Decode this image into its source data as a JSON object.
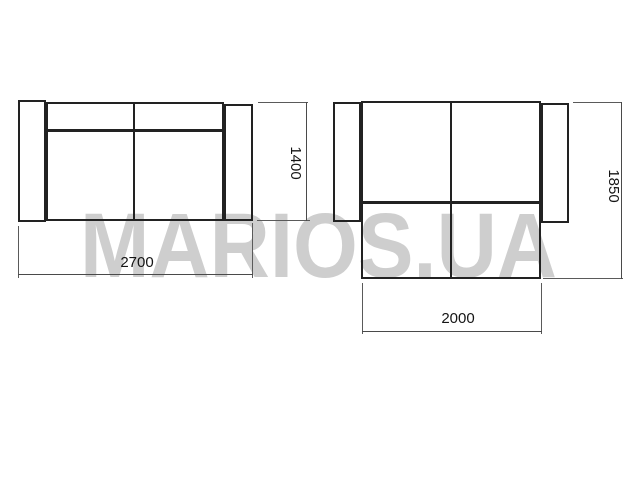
{
  "watermark": {
    "text": "MARIOS.UA",
    "color": "#cecece"
  },
  "colors": {
    "background": "#ffffff",
    "outline": "#222222",
    "dimension_line": "#4a4a4a",
    "label_text": "#151515"
  },
  "views": {
    "straight_sofa_top_view": {
      "dimensions": {
        "width": "2700",
        "depth": "1400"
      }
    },
    "corner_sofa_top_view": {
      "dimensions": {
        "chaise_width": "2000",
        "depth": "1850"
      }
    }
  }
}
